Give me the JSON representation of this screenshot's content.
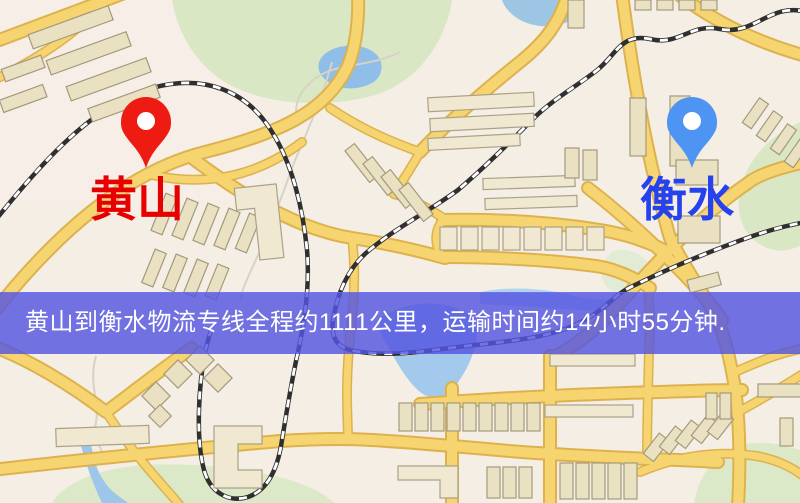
{
  "app": {
    "title": "黄山到衡水物流专线地图",
    "type": "logistics-route-map"
  },
  "markers": {
    "origin": {
      "label": "黄山",
      "pin_color": "#ee1b12",
      "label_color": "#e60000"
    },
    "destination": {
      "label": "衡水",
      "pin_color": "#4e94f2",
      "label_color": "#2742ec"
    }
  },
  "banner": {
    "text": "黄山到衡水物流专线全程约1111公里，运输时间约14小时55分钟.",
    "distance_km": "1111",
    "duration": "14小时55分钟",
    "bg_color": "rgba(84,86,225,0.82)",
    "text_color": "#ffffff"
  },
  "palette": {
    "map_background": "#f4eee4",
    "road_fill": "#f6d571",
    "road_casing": "#ddb24e",
    "park_green": "#d9e7c5",
    "water_blue": "#8fbfe8",
    "building_tan": "#eae1c2",
    "railway_dark": "#2f2f2f"
  }
}
